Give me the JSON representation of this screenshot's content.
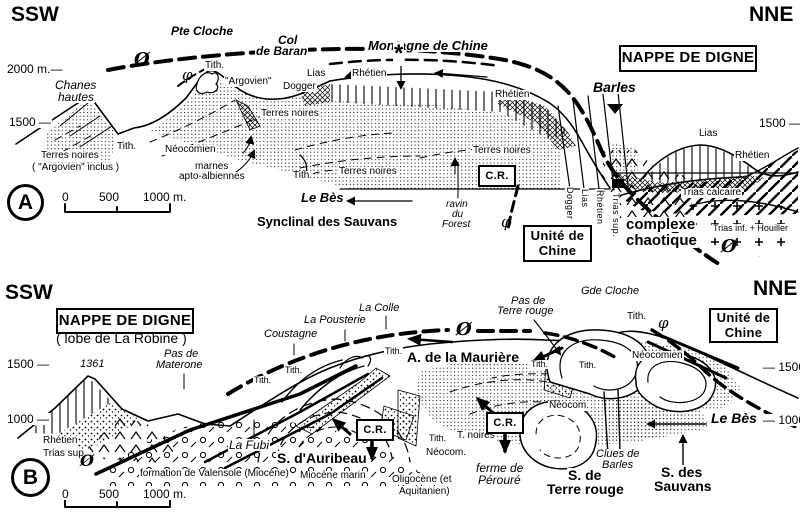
{
  "figure": {
    "ink_color": "#000000",
    "paper_color": "#ffffff",
    "panel_letters": [
      "A",
      "B"
    ]
  },
  "panel_markers": [
    {
      "letter": "A",
      "x": 7,
      "y": 184,
      "d": 31
    },
    {
      "letter": "B",
      "x": 11,
      "y": 458,
      "d": 33
    }
  ],
  "boxed_labels": [
    {
      "lines": [
        "NAPPE DE DIGNE"
      ],
      "x": 619,
      "y": 45,
      "w": 134,
      "h": 23,
      "fs": 15
    },
    {
      "lines": [
        "Unité de",
        "Chine"
      ],
      "x": 523,
      "y": 225,
      "w": 65,
      "h": 33,
      "fs": 13
    },
    {
      "lines": [
        "C.R."
      ],
      "x": 478,
      "y": 165,
      "w": 34,
      "h": 18,
      "fs": 11
    },
    {
      "lines": [
        "NAPPE DE DIGNE"
      ],
      "x": 56,
      "y": 308,
      "w": 134,
      "h": 22,
      "fs": 15
    },
    {
      "lines": [
        "Unité de",
        "Chine"
      ],
      "x": 709,
      "y": 308,
      "w": 65,
      "h": 31,
      "fs": 13
    },
    {
      "lines": [
        "C.R."
      ],
      "x": 356,
      "y": 419,
      "w": 34,
      "h": 18,
      "fs": 11
    },
    {
      "lines": [
        "C.R."
      ],
      "x": 486,
      "y": 412,
      "w": 34,
      "h": 18,
      "fs": 11
    }
  ],
  "labels": [
    {
      "t": "SSW",
      "x": 10,
      "y": 4,
      "c": "bd",
      "fs": 21,
      "n": "compass-ssw-a"
    },
    {
      "t": "NNE",
      "x": 748,
      "y": 4,
      "c": "bd",
      "fs": 21,
      "n": "compass-nne-a"
    },
    {
      "t": "Pte Cloche",
      "x": 170,
      "y": 25,
      "c": "ib",
      "fs": 12
    },
    {
      "t": "Col",
      "x": 277,
      "y": 34,
      "c": "ib",
      "fs": 12
    },
    {
      "t": "de Baran",
      "x": 255,
      "y": 45,
      "c": "ib",
      "fs": 12
    },
    {
      "t": "Montagne de Chine",
      "x": 367,
      "y": 39,
      "c": "ib",
      "fs": 13
    },
    {
      "t": "*",
      "x": 393,
      "y": 42,
      "c": "bd",
      "fs": 24,
      "n": "asterisk-marker"
    },
    {
      "t": "Barles",
      "x": 592,
      "y": 80,
      "c": "ib",
      "fs": 14
    },
    {
      "t": "Ø",
      "x": 133,
      "y": 51,
      "c": "phb",
      "fs": 18,
      "n": "phi-major-thrust-symbol"
    },
    {
      "t": "φ",
      "x": 181,
      "y": 68,
      "c": "ph",
      "fs": 15,
      "n": "phi-symbol"
    },
    {
      "t": "Tith.",
      "x": 204,
      "y": 61,
      "fs": 10
    },
    {
      "t": "\"Argovien\"",
      "x": 224,
      "y": 77,
      "fs": 10
    },
    {
      "t": "Dogger",
      "x": 282,
      "y": 82,
      "fs": 10
    },
    {
      "t": "Lias",
      "x": 306,
      "y": 69,
      "fs": 10
    },
    {
      "t": "Rhétien",
      "x": 351,
      "y": 69,
      "fs": 10
    },
    {
      "t": "Terres noires",
      "x": 260,
      "y": 109,
      "fs": 10
    },
    {
      "t": "Rhétien",
      "x": 494,
      "y": 90,
      "fs": 10
    },
    {
      "t": "Chanes",
      "x": 54,
      "y": 79,
      "c": "it",
      "fs": 12
    },
    {
      "t": "hautes",
      "x": 57,
      "y": 91,
      "c": "it",
      "fs": 12
    },
    {
      "t": "2000 m.—",
      "x": 6,
      "y": 63,
      "fs": 12,
      "n": "elevation-2000-left-a"
    },
    {
      "t": "1500 —",
      "x": 8,
      "y": 116,
      "fs": 12,
      "n": "elevation-1500-left-a"
    },
    {
      "t": "1500 —",
      "x": 758,
      "y": 117,
      "fs": 12,
      "n": "elevation-1500-right-a"
    },
    {
      "t": "Terres noires",
      "x": 40,
      "y": 151,
      "fs": 10
    },
    {
      "t": "( \"Argovien\" inclus )",
      "x": 31,
      "y": 163,
      "fs": 10
    },
    {
      "t": "Tith.",
      "x": 116,
      "y": 142,
      "fs": 10
    },
    {
      "t": "Néocomien",
      "x": 164,
      "y": 145,
      "fs": 10
    },
    {
      "t": "marnes",
      "x": 194,
      "y": 162,
      "fs": 10
    },
    {
      "t": "apto-albiennes",
      "x": 178,
      "y": 172,
      "fs": 10
    },
    {
      "t": "Tith.",
      "x": 292,
      "y": 171,
      "fs": 10
    },
    {
      "t": "Terres noires",
      "x": 338,
      "y": 167,
      "fs": 10
    },
    {
      "t": "Terres noires",
      "x": 472,
      "y": 146,
      "fs": 10
    },
    {
      "t": "Le Bès",
      "x": 300,
      "y": 191,
      "c": "ib",
      "fs": 13
    },
    {
      "t": "Synclinal des Sauvans",
      "x": 256,
      "y": 215,
      "c": "bd",
      "fs": 13
    },
    {
      "t": "ravin",
      "x": 445,
      "y": 200,
      "c": "it",
      "fs": 10
    },
    {
      "t": "du",
      "x": 451,
      "y": 210,
      "c": "it",
      "fs": 10
    },
    {
      "t": "Forest",
      "x": 441,
      "y": 220,
      "c": "it",
      "fs": 10
    },
    {
      "t": "φ",
      "x": 500,
      "y": 215,
      "c": "ph",
      "fs": 15,
      "n": "phi-symbol"
    },
    {
      "t": "complexe",
      "x": 625,
      "y": 217,
      "c": "bd",
      "fs": 15
    },
    {
      "t": "chaotique",
      "x": 625,
      "y": 233,
      "c": "bd",
      "fs": 15
    },
    {
      "t": "Trias calcaire",
      "x": 681,
      "y": 188,
      "fs": 10
    },
    {
      "t": "Trias inf. + Houiller",
      "x": 712,
      "y": 224,
      "fs": 9
    },
    {
      "t": "Ø",
      "x": 720,
      "y": 238,
      "c": "phb",
      "fs": 18,
      "n": "phi-major-thrust-symbol"
    },
    {
      "t": "Lias",
      "x": 698,
      "y": 129,
      "fs": 10
    },
    {
      "t": "Rhétien",
      "x": 734,
      "y": 151,
      "fs": 10
    },
    {
      "t": "Dogger",
      "x": 565,
      "y": 186,
      "c": "vt",
      "fs": 9
    },
    {
      "t": "Lias",
      "x": 580,
      "y": 188,
      "c": "vt",
      "fs": 9
    },
    {
      "t": "Rhétien",
      "x": 595,
      "y": 189,
      "c": "vt",
      "fs": 9
    },
    {
      "t": "Trias sup.",
      "x": 611,
      "y": 192,
      "c": "vt",
      "fs": 9
    },
    {
      "t": "0",
      "x": 61,
      "y": 191,
      "fs": 12,
      "n": "scalebar-a-0"
    },
    {
      "t": "500",
      "x": 98,
      "y": 191,
      "fs": 12,
      "n": "scalebar-a-500"
    },
    {
      "t": "1000 m.",
      "x": 142,
      "y": 191,
      "fs": 12,
      "n": "scalebar-a-1000"
    },
    {
      "t": "SSW",
      "x": 4,
      "y": 282,
      "c": "bd",
      "fs": 21,
      "n": "compass-ssw-b"
    },
    {
      "t": "NNE",
      "x": 752,
      "y": 278,
      "c": "bd",
      "fs": 21,
      "n": "compass-nne-b"
    },
    {
      "t": "( lobe de La Robine )",
      "x": 55,
      "y": 331,
      "fs": 14
    },
    {
      "t": "1500 —",
      "x": 6,
      "y": 358,
      "fs": 12,
      "n": "elevation-1500-left-b"
    },
    {
      "t": "1000 —",
      "x": 6,
      "y": 413,
      "fs": 12,
      "n": "elevation-1000-left-b"
    },
    {
      "t": "— 1500",
      "x": 762,
      "y": 361,
      "fs": 12,
      "n": "elevation-1500-right-b"
    },
    {
      "t": "— 1000",
      "x": 762,
      "y": 414,
      "fs": 12,
      "n": "elevation-1000-right-b"
    },
    {
      "t": "1361",
      "x": 79,
      "y": 359,
      "c": "it",
      "fs": 11,
      "n": "spot-height-1361"
    },
    {
      "t": "Pas de",
      "x": 163,
      "y": 349,
      "c": "it",
      "fs": 11
    },
    {
      "t": "Materone",
      "x": 155,
      "y": 360,
      "c": "it",
      "fs": 11
    },
    {
      "t": "Coustagne",
      "x": 263,
      "y": 329,
      "c": "it",
      "fs": 11
    },
    {
      "t": "La Pousterie",
      "x": 303,
      "y": 315,
      "c": "it",
      "fs": 11
    },
    {
      "t": "La Colle",
      "x": 358,
      "y": 303,
      "c": "it",
      "fs": 11
    },
    {
      "t": "Ø",
      "x": 455,
      "y": 321,
      "c": "phb",
      "fs": 18,
      "n": "phi-major-thrust-symbol"
    },
    {
      "t": "Pas de",
      "x": 510,
      "y": 296,
      "c": "it",
      "fs": 11
    },
    {
      "t": "Terre rouge",
      "x": 496,
      "y": 306,
      "c": "it",
      "fs": 11
    },
    {
      "t": "Gde Cloche",
      "x": 580,
      "y": 286,
      "c": "it",
      "fs": 11
    },
    {
      "t": "Tith.",
      "x": 626,
      "y": 312,
      "fs": 10
    },
    {
      "t": "φ",
      "x": 657,
      "y": 316,
      "c": "ph",
      "fs": 15,
      "n": "phi-symbol"
    },
    {
      "t": "A. de la Maurière",
      "x": 406,
      "y": 350,
      "c": "bd",
      "fs": 14
    },
    {
      "t": "Tith.",
      "x": 384,
      "y": 347,
      "fs": 9
    },
    {
      "t": "Tith.",
      "x": 284,
      "y": 366,
      "fs": 9
    },
    {
      "t": "Tith.",
      "x": 253,
      "y": 376,
      "fs": 9
    },
    {
      "t": "Tith.",
      "x": 530,
      "y": 360,
      "fs": 9
    },
    {
      "t": "Tith.",
      "x": 578,
      "y": 361,
      "fs": 9
    },
    {
      "t": "Néocomien",
      "x": 631,
      "y": 351,
      "fs": 10
    },
    {
      "t": "Rhétien",
      "x": 42,
      "y": 436,
      "fs": 10
    },
    {
      "t": "Trias sup.",
      "x": 42,
      "y": 449,
      "fs": 10
    },
    {
      "t": "Ø",
      "x": 79,
      "y": 453,
      "c": "phb",
      "fs": 16,
      "n": "phi-major-thrust-symbol"
    },
    {
      "t": "La Fubi",
      "x": 228,
      "y": 439,
      "c": "it",
      "fs": 12
    },
    {
      "t": "S. d'Auribeau",
      "x": 276,
      "y": 451,
      "c": "bd",
      "fs": 14
    },
    {
      "t": "formation de Valensole (Miocène)",
      "x": 139,
      "y": 469,
      "fs": 10
    },
    {
      "t": "Miocène marin",
      "x": 299,
      "y": 471,
      "fs": 10
    },
    {
      "t": "Oligocène (et",
      "x": 391,
      "y": 475,
      "fs": 10
    },
    {
      "t": "Aquitanien)",
      "x": 398,
      "y": 487,
      "fs": 10
    },
    {
      "t": "Tith.",
      "x": 428,
      "y": 434,
      "fs": 9
    },
    {
      "t": "T. noires",
      "x": 456,
      "y": 431,
      "fs": 10
    },
    {
      "t": "Néocom.",
      "x": 425,
      "y": 448,
      "fs": 10
    },
    {
      "t": "Néocom.",
      "x": 548,
      "y": 401,
      "fs": 10
    },
    {
      "t": "ferme de",
      "x": 475,
      "y": 462,
      "c": "it",
      "fs": 12
    },
    {
      "t": "Pérouré",
      "x": 477,
      "y": 474,
      "c": "it",
      "fs": 12
    },
    {
      "t": "S. de",
      "x": 567,
      "y": 468,
      "c": "bd",
      "fs": 14
    },
    {
      "t": "Terre rouge",
      "x": 546,
      "y": 482,
      "c": "bd",
      "fs": 14
    },
    {
      "t": "Clues de",
      "x": 595,
      "y": 449,
      "c": "it",
      "fs": 11
    },
    {
      "t": "Barles",
      "x": 601,
      "y": 460,
      "c": "it",
      "fs": 11
    },
    {
      "t": "S. des",
      "x": 660,
      "y": 465,
      "c": "bd",
      "fs": 14
    },
    {
      "t": "Sauvans",
      "x": 653,
      "y": 479,
      "c": "bd",
      "fs": 14
    },
    {
      "t": "Le Bès",
      "x": 710,
      "y": 411,
      "c": "ib",
      "fs": 14
    },
    {
      "t": "0",
      "x": 61,
      "y": 488,
      "fs": 12,
      "n": "scalebar-b-0"
    },
    {
      "t": "500",
      "x": 98,
      "y": 488,
      "fs": 12,
      "n": "scalebar-b-500"
    },
    {
      "t": "1000 m.",
      "x": 142,
      "y": 488,
      "fs": 12,
      "n": "scalebar-b-1000"
    }
  ]
}
